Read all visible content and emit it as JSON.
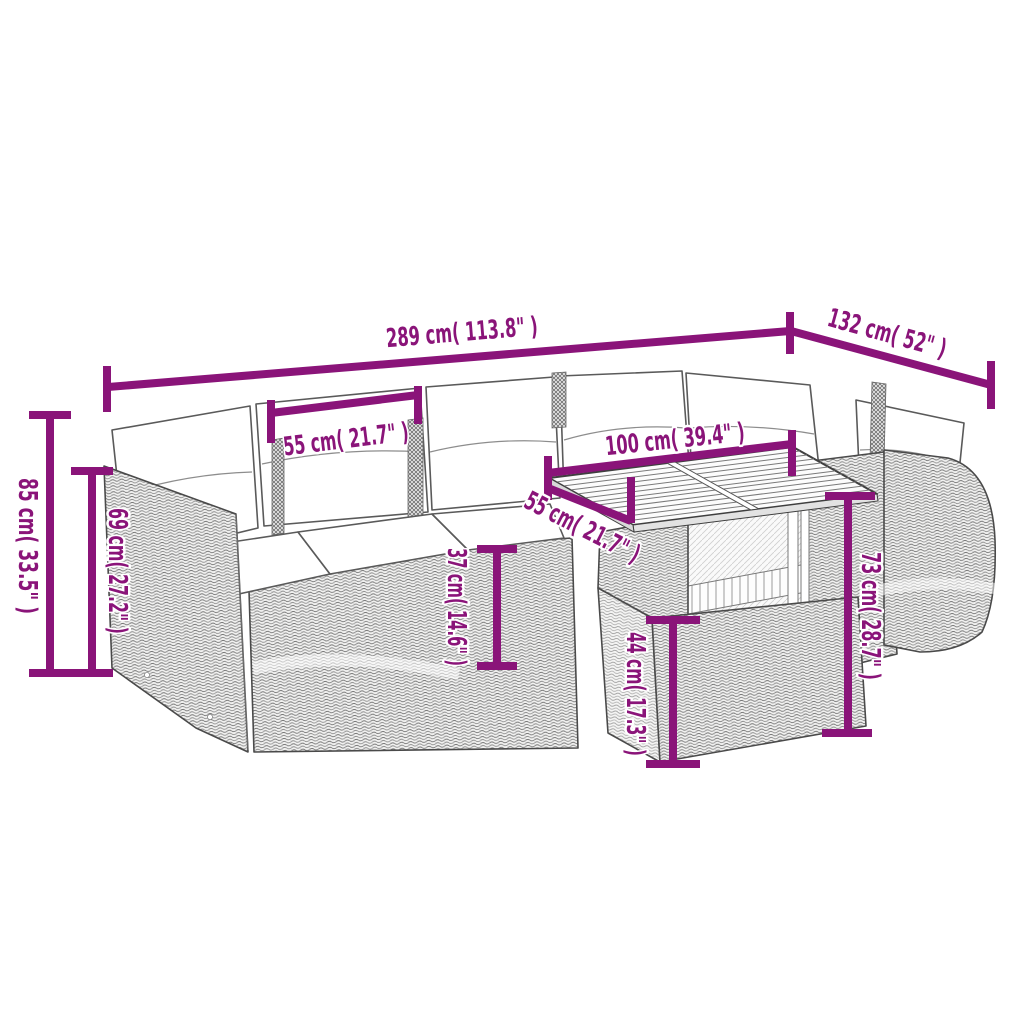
{
  "diagram": {
    "type": "product-dimension-diagram",
    "background_color": "#ffffff",
    "accent_color": "#8A1479",
    "line_art_color": "#4a4a4a",
    "annotations": {
      "sofa_width": {
        "label": "289 cm( 113.8\" )",
        "cm": 289,
        "inches": 113.8
      },
      "sofa_side_depth": {
        "label": "132 cm( 52\" )",
        "cm": 132,
        "inches": 52
      },
      "seat_width": {
        "label": "55 cm( 21.7\" )",
        "cm": 55,
        "inches": 21.7
      },
      "table_width": {
        "label": "100 cm( 39.4\" )",
        "cm": 100,
        "inches": 39.4
      },
      "table_depth": {
        "label": "55 cm( 21.7\" )",
        "cm": 55,
        "inches": 21.7
      },
      "sofa_height": {
        "label": "85 cm( 33.5\" )",
        "cm": 85,
        "inches": 33.5
      },
      "backrest_height": {
        "label": "69 cm( 27.2\" )",
        "cm": 69,
        "inches": 27.2
      },
      "seat_height": {
        "label": "37 cm( 14.6\" )",
        "cm": 37,
        "inches": 14.6
      },
      "table_base_height": {
        "label": "44 cm( 17.3\" )",
        "cm": 44,
        "inches": 17.3
      },
      "table_height": {
        "label": "73 cm( 28.7\" )",
        "cm": 73,
        "inches": 28.7
      }
    }
  }
}
